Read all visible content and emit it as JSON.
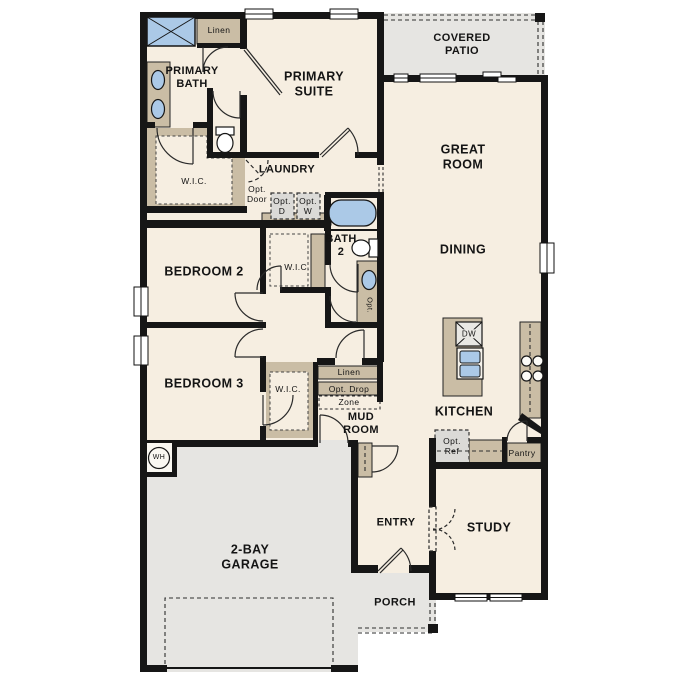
{
  "meta": {
    "type": "residential-floor-plan",
    "bays": "2-bay"
  },
  "colors": {
    "floor": "#f6eee1",
    "exterior_concrete": "#e6e5e2",
    "casework_tan": "#cabda5",
    "wall_black": "#161616",
    "fixture_blue": "#abc9e7",
    "optional_box_gray": "#dbdad7"
  },
  "labels": [
    {
      "id": "linen-primary",
      "text": "Linen",
      "x": 219,
      "y": 30,
      "fs": 8.5
    },
    {
      "id": "primary-bath",
      "text": "PRIMARY\nBATH",
      "x": 192,
      "y": 78,
      "fs": 11,
      "fw": 700
    },
    {
      "id": "primary-suite",
      "text": "PRIMARY\nSUITE",
      "x": 314,
      "y": 84,
      "fs": 12.5,
      "fw": 700
    },
    {
      "id": "covered-patio",
      "text": "COVERED\nPATIO",
      "x": 462,
      "y": 45,
      "fs": 11,
      "fw": 700
    },
    {
      "id": "great-room",
      "text": "GREAT\nROOM",
      "x": 463,
      "y": 157,
      "fs": 12.5,
      "fw": 700
    },
    {
      "id": "wic-primary",
      "text": "W.I.C.",
      "x": 194,
      "y": 181,
      "fs": 8.5
    },
    {
      "id": "laundry",
      "text": "LAUNDRY",
      "x": 287,
      "y": 170,
      "fs": 11,
      "fw": 700
    },
    {
      "id": "opt-door",
      "text": "Opt.\nDoor",
      "x": 257,
      "y": 194,
      "fs": 8.5
    },
    {
      "id": "opt-dryer",
      "text": "Opt.\nD",
      "x": 282,
      "y": 206,
      "fs": 8.5
    },
    {
      "id": "opt-washer",
      "text": "Opt.\nW",
      "x": 308,
      "y": 206,
      "fs": 8.5
    },
    {
      "id": "bath-2",
      "text": "BATH\n2",
      "x": 341,
      "y": 246,
      "fs": 11,
      "fw": 700
    },
    {
      "id": "dining",
      "text": "DINING",
      "x": 463,
      "y": 250,
      "fs": 12.5,
      "fw": 700
    },
    {
      "id": "opt-sink",
      "text": "Opt.",
      "x": 369,
      "y": 305,
      "fs": 7.5,
      "rot": 90
    },
    {
      "id": "bedroom-2",
      "text": "BEDROOM 2",
      "x": 204,
      "y": 272,
      "fs": 12.5,
      "fw": 700
    },
    {
      "id": "wic-bedroom-2",
      "text": "W.I.C.",
      "x": 297,
      "y": 267,
      "fs": 8.5
    },
    {
      "id": "bedroom-3",
      "text": "BEDROOM 3",
      "x": 204,
      "y": 384,
      "fs": 12.5,
      "fw": 700
    },
    {
      "id": "wic-bedroom-3",
      "text": "W.I.C.",
      "x": 288,
      "y": 389,
      "fs": 8.5
    },
    {
      "id": "linen-mud",
      "text": "Linen",
      "x": 349,
      "y": 372,
      "fs": 8.5
    },
    {
      "id": "opt-drop",
      "text": "Opt. Drop",
      "x": 349,
      "y": 389,
      "fs": 8.5
    },
    {
      "id": "zone",
      "text": "Zone",
      "x": 349,
      "y": 402,
      "fs": 8.5
    },
    {
      "id": "mud-room",
      "text": "MUD\nROOM",
      "x": 361,
      "y": 424,
      "fs": 11,
      "fw": 700
    },
    {
      "id": "dishwasher",
      "text": "DW",
      "x": 469,
      "y": 334,
      "fs": 8,
      "bg": "#e9e8e4"
    },
    {
      "id": "kitchen",
      "text": "KITCHEN",
      "x": 464,
      "y": 412,
      "fs": 12.5,
      "fw": 700
    },
    {
      "id": "opt-ref",
      "text": "Opt.\nRef",
      "x": 452,
      "y": 446,
      "fs": 8.5
    },
    {
      "id": "pantry",
      "text": "Pantry",
      "x": 522,
      "y": 453,
      "fs": 8.5
    },
    {
      "id": "water-heater",
      "text": "WH",
      "x": 159,
      "y": 458,
      "fs": 7
    },
    {
      "id": "garage",
      "text": "2-BAY\nGARAGE",
      "x": 250,
      "y": 557,
      "fs": 12.5,
      "fw": 700
    },
    {
      "id": "entry",
      "text": "ENTRY",
      "x": 396,
      "y": 523,
      "fs": 11,
      "fw": 700
    },
    {
      "id": "study",
      "text": "STUDY",
      "x": 489,
      "y": 528,
      "fs": 12.5,
      "fw": 700
    },
    {
      "id": "porch",
      "text": "PORCH",
      "x": 395,
      "y": 603,
      "fs": 11,
      "fw": 700
    }
  ]
}
